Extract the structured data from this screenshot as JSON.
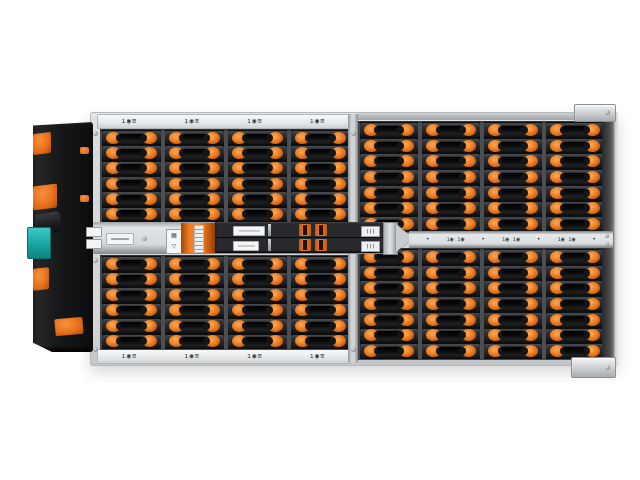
{
  "page": {
    "background": "#ffffff",
    "description": "Top view product photograph of a high-density rack storage enclosure with orange drive release latches"
  },
  "colors": {
    "accent_orange": "#e8701a",
    "teal_connector": "#1fb3b0",
    "chassis_silver": "#d6d9db",
    "drive_body_dark": "#232527",
    "side_panel_black": "#141517",
    "rail_light": "#eef0f1",
    "right_edge_dark": "#3a3d40"
  },
  "enclosure": {
    "view": "top",
    "drive_bays_visible": 104,
    "left_bank": {
      "columns": 4,
      "rows_top": 6,
      "rows_bottom": 6,
      "drives": 48,
      "top_rail_labels": [
        "ı◉≡",
        "ı◉≡",
        "ı◉≡",
        "ı◉≡"
      ],
      "bottom_rail_labels": [
        "ı◉≡",
        "ı◉≡",
        "ı◉≡",
        "ı◉≡"
      ]
    },
    "right_bank": {
      "columns": 4,
      "rows_top": 7,
      "rows_bottom": 7,
      "drives": 56,
      "mid_rail_items": [
        "•",
        "ı◉ ı◉",
        "•",
        "ı◉ ı◉",
        "•",
        "ı◉ ı◉",
        "•"
      ]
    },
    "io_assembly": {
      "module_rows": 2,
      "orange_clips": 4,
      "icon_box_glyphs": [
        "▦",
        "▽"
      ]
    },
    "side_panel": {
      "position": "left",
      "orange_clips": 4
    }
  },
  "grids": {
    "left_top": {
      "cols": 4,
      "rows": 6
    },
    "left_bottom": {
      "cols": 4,
      "rows": 6
    },
    "right_top": {
      "cols": 4,
      "rows": 7
    },
    "right_bottom": {
      "cols": 4,
      "rows": 7
    }
  }
}
